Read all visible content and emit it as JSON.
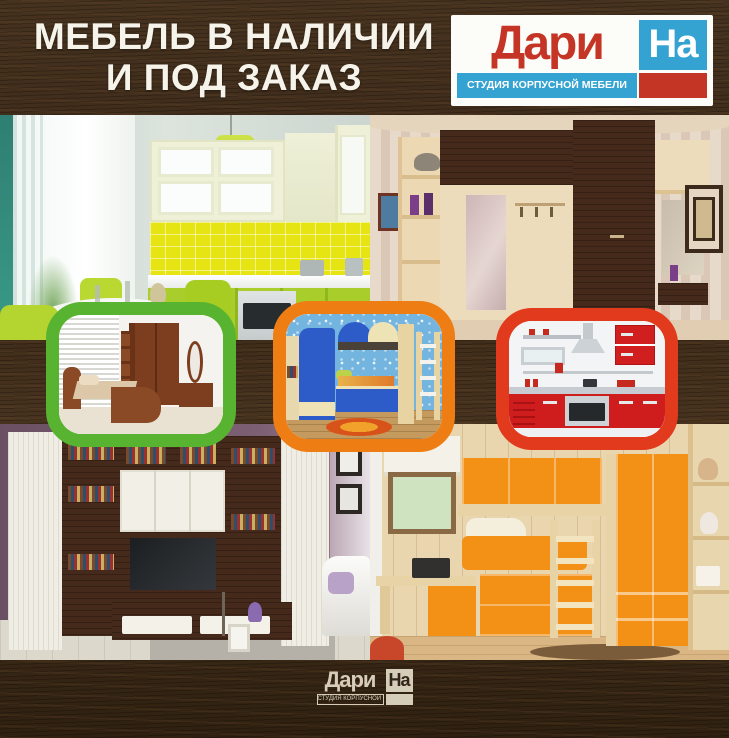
{
  "header": {
    "title_line1": "МЕБЕЛЬ В НАЛИЧИИ",
    "title_line2": "И ПОД ЗАКАЗ"
  },
  "logo": {
    "name_part1": "Дари",
    "name_part2": "На",
    "tagline": "СТУДИЯ КОРПУСНОЙ МЕБЕЛИ"
  },
  "footer_logo": {
    "name_part1": "Дари",
    "name_part2": "На",
    "tagline": "СТУДИЯ КОРПУСНОЙ МЕБЕЛИ"
  },
  "palette": {
    "wood_dark": "#3a2a1c",
    "headline_text": "#f6f3ea",
    "logo_red": "#c53526",
    "logo_blue": "#35a3d2",
    "footer_cream": "#d6cdb8",
    "thumb_border_green": "#58b331",
    "thumb_border_orange": "#ee7e14",
    "thumb_border_red": "#e23a1c"
  },
  "gallery": {
    "photos": [
      {
        "name": "lime-kitchen"
      },
      {
        "name": "corner-hallway-wardrobe"
      },
      {
        "name": "living-room-wall-unit"
      },
      {
        "name": "orange-kids-room"
      }
    ],
    "thumbnails": [
      {
        "name": "bedroom-set",
        "border_color": "#58b331"
      },
      {
        "name": "kids-bunk-room",
        "border_color": "#ee7e14"
      },
      {
        "name": "red-kitchen",
        "border_color": "#e23a1c"
      }
    ]
  }
}
